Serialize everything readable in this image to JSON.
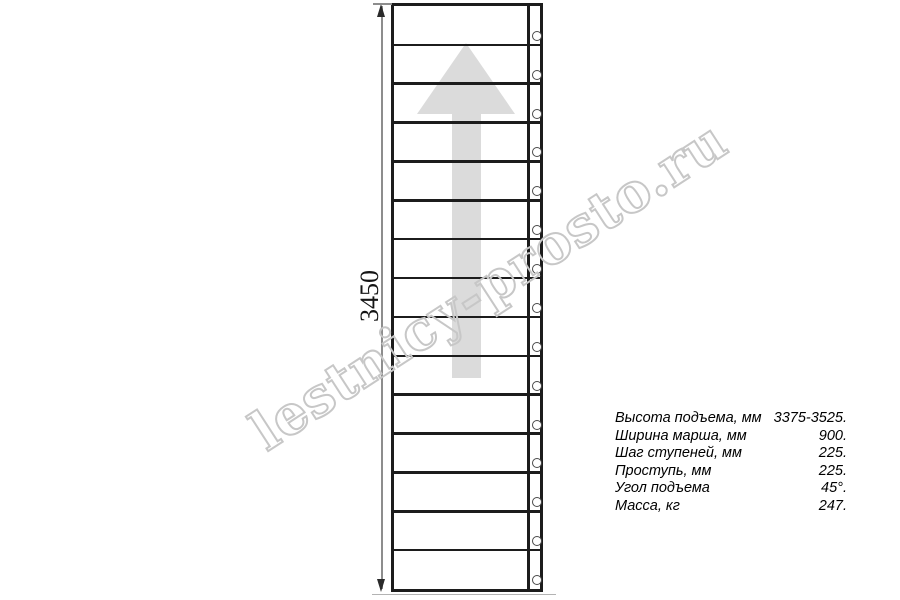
{
  "drawing": {
    "dimension_label": "3450",
    "step_count": 15,
    "arrow_direction": "up",
    "colors": {
      "line": "#1c1c1c",
      "arrow": "#dbdbdb",
      "watermark": "#c7c7c7"
    }
  },
  "watermark": {
    "text": "lestnicy-prosto.ru"
  },
  "specs": {
    "rows": [
      {
        "label": "Высота подъема, мм",
        "value": "3375-3525."
      },
      {
        "label": "Ширина марша, мм",
        "value": "900."
      },
      {
        "label": "Шаг ступеней, мм",
        "value": "225."
      },
      {
        "label": "Проступь, мм",
        "value": "225."
      },
      {
        "label": "Угол подъема",
        "value": "45°."
      },
      {
        "label": "Масса, кг",
        "value": "247."
      }
    ]
  }
}
